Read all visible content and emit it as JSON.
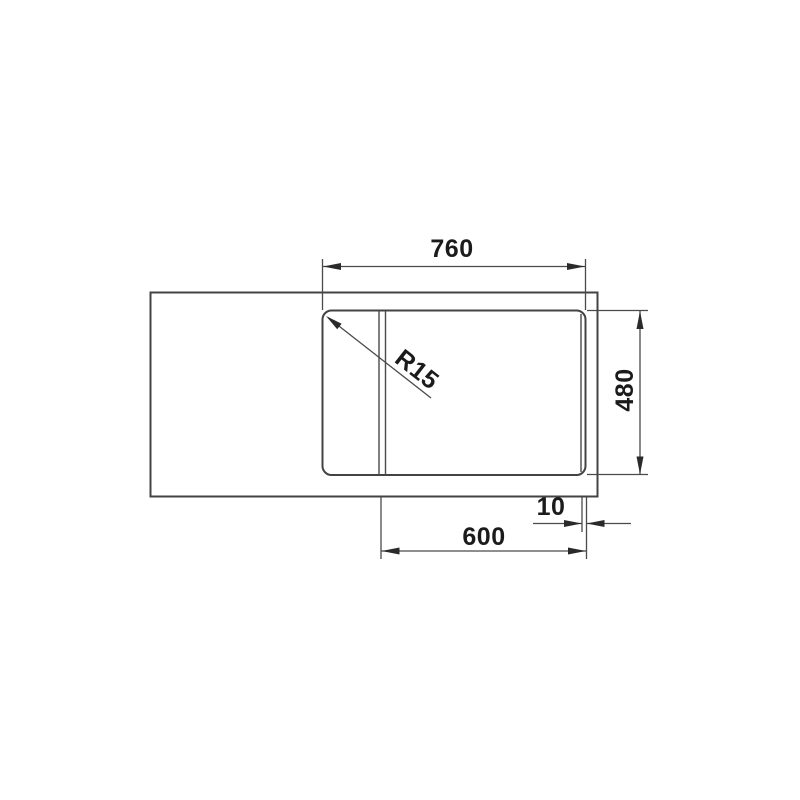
{
  "colors": {
    "background": "#ffffff",
    "drawing_line": "#434343",
    "dimension_line": "#4a4a4a",
    "label_text": "#1b1b1b"
  },
  "drawing": {
    "kind": "sink-top-view-dimension-drawing",
    "labels": {
      "dim_top_width": "760",
      "dim_right_height": "480",
      "dim_bottom_width": "600",
      "dim_bottom_offset": "10",
      "corner_radius": "R15"
    }
  }
}
